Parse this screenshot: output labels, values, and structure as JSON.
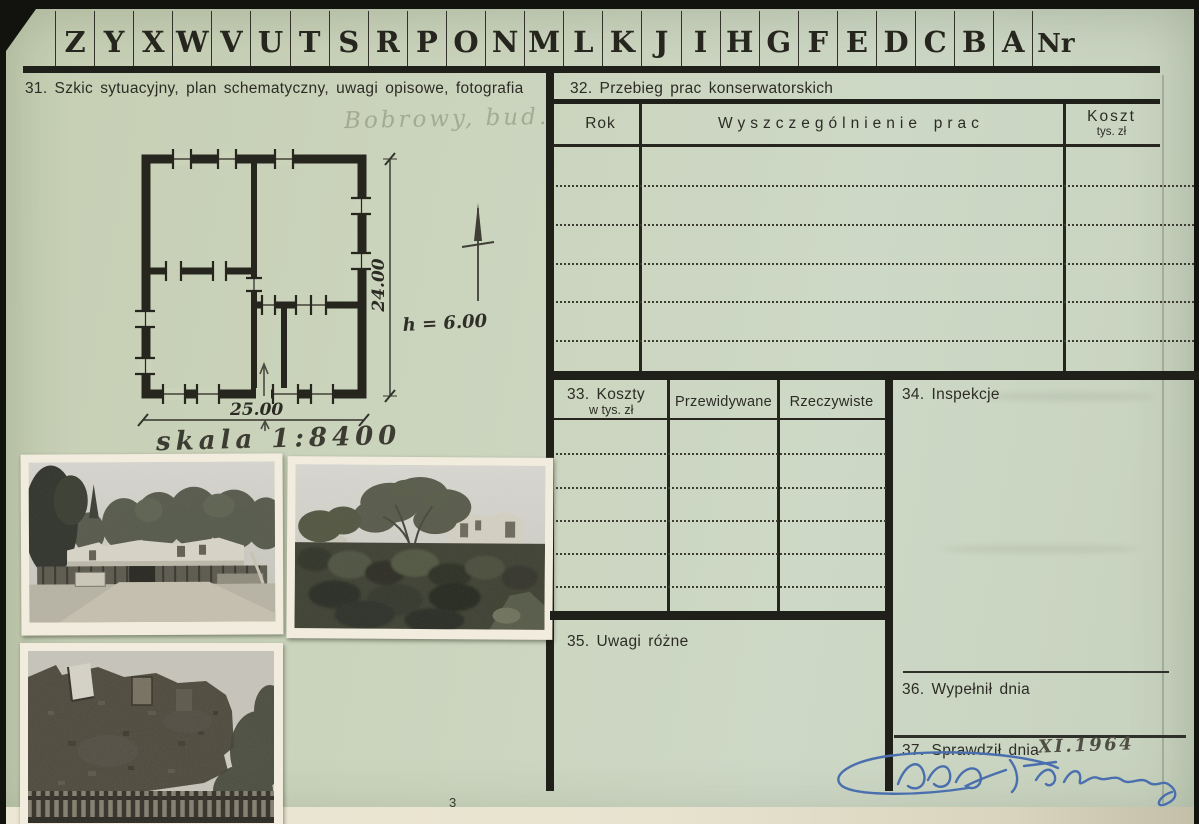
{
  "colors": {
    "paper": "#c9d2ba",
    "ink": "#2c2c25",
    "rule": "#20201b",
    "pencil_faint": "#8e9480",
    "pencil_dark": "#4a4a40",
    "blue_ink": "#4a6fae",
    "photo_frame": "#f1ecdd",
    "cream_edge": "#e8e3cf"
  },
  "index_tabs": {
    "letters": [
      "Z",
      "Y",
      "X",
      "W",
      "V",
      "U",
      "T",
      "S",
      "R",
      "P",
      "O",
      "N",
      "M",
      "L",
      "K",
      "J",
      "I",
      "H",
      "G",
      "F",
      "E",
      "D",
      "C",
      "B",
      "A"
    ],
    "nr": "Nr"
  },
  "s31": {
    "title": "31. Szkic sytuacyjny, plan schematyczny, uwagi opisowe, fotografia",
    "pencil_note": "Bobrowy, bud.",
    "plan": {
      "dim_width": "25.00",
      "dim_height": "24.00",
      "wall_height": "h = 6.00",
      "scale": "skala 1:8400"
    },
    "margin_mark": "3"
  },
  "s32": {
    "title": "32. Przebieg prac konserwatorskich",
    "col_rok": "Rok",
    "col_prace": "Wyszczególnienie prac",
    "col_koszt": "Koszt",
    "col_koszt_sub": "tys. zł"
  },
  "s33": {
    "title": "33. Koszty",
    "subtitle": "w tys. zł",
    "col_przewidywane": "Przewidywane",
    "col_rzeczywiste": "Rzeczywiste"
  },
  "s34": {
    "title": "34. Inspekcje"
  },
  "s35": {
    "title": "35. Uwagi różne"
  },
  "s36": {
    "title": "36. Wypełnił dnia"
  },
  "s37": {
    "title": "37. Sprawdził dnia",
    "handwritten_date": "XI.1964"
  }
}
